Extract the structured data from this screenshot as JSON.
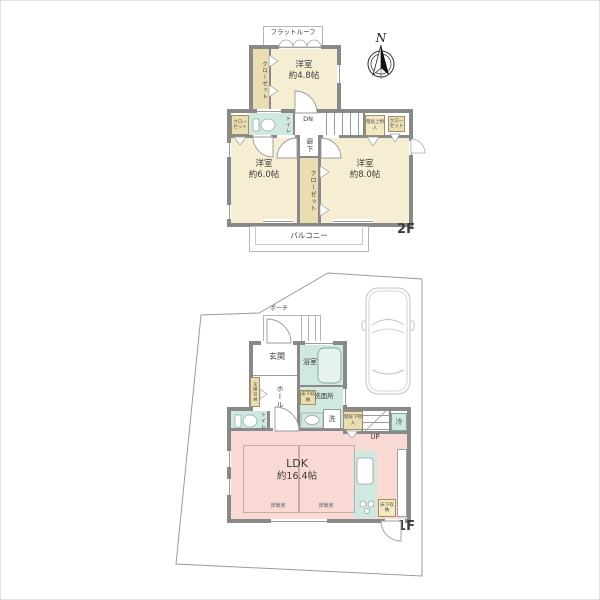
{
  "title": "2-story house floor plan",
  "compass": {
    "label": "N"
  },
  "floor2": {
    "label": "2F",
    "flat_roof": "フラットルーフ",
    "closet": "クローゼット",
    "room48": {
      "name": "洋室",
      "size": "約4.8帖"
    },
    "room60": {
      "name": "洋室",
      "size": "約6.0帖"
    },
    "room80": {
      "name": "洋室",
      "size": "約8.0帖"
    },
    "toilet": "トイレ",
    "dn": "DN",
    "corridor": "廊下",
    "stair_storage": "階段上物入",
    "balcony": "バルコニー"
  },
  "floor1": {
    "label": "1F",
    "porch": "ポーチ",
    "entrance": "玄関",
    "entrance_storage": "玄関収納",
    "hall": "ホール",
    "bath": "浴室",
    "washroom": "洗面所",
    "underfloor_storage": "床下収納",
    "laundry": "洗",
    "toilet": "トイレ",
    "stair_storage": "階段下物入",
    "up": "UP",
    "fridge": "冷",
    "ldk": {
      "name": "LDK",
      "size": "約16.4帖"
    },
    "floor_heating": "床暖房"
  },
  "colors": {
    "room_cream": "#f5eed2",
    "closet_tan": "#eaddb1",
    "storage_yellow": "#f2e8c2",
    "wet_area_teal": "#cfe8e0",
    "ldk_pink": "#f8d9d3",
    "wall_gray": "#898989",
    "floor_heating_outline": "#c9aaa4"
  }
}
